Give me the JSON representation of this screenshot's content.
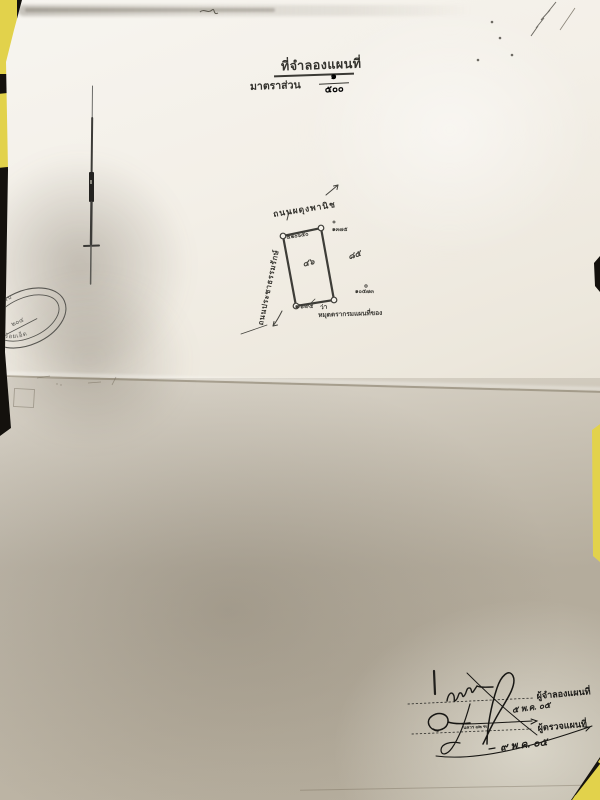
{
  "header": {
    "title": "ที่จำลองแผนที่",
    "scale_label": "มาตราส่วน",
    "scale_numerator": "๑",
    "scale_denominator": "๕๐๐"
  },
  "plot_sketch": {
    "road_top_label": "ถนนผดุงพานิช",
    "road_left_label": "ถนนประชาธรรมรักษ์",
    "corner_labels": {
      "top_left": "๕๒๐๖๕๐",
      "top_right": "๑๓๗๕",
      "bottom_right": "๑๐๕๗๓",
      "bottom_left": "๑/๖/๙๕"
    },
    "inner_mark": "๔๖",
    "side_mark": "๘๕",
    "annotation_prefix": "ว่า",
    "annotation": "หมุดตรากรมแผนที่ของ"
  },
  "stamp": {
    "arc_top": "ทะเบียนรับ",
    "number": "๒๐๔",
    "arc_bottom": "ร้อยเอ็ด"
  },
  "signature_block": {
    "line1_label": "ผู้จำลองแผนที่",
    "line1_date": "๕ พ.ค. ๐๕",
    "line2_label": "ผู้ตรวจแผนที่",
    "line2_date": "๙ พ.ค. ๐๕",
    "line2_note": "นควร ๗๒ ฑ"
  },
  "colors": {
    "paper": "#f3efe7",
    "background": "#14110d",
    "fabric_yellow": "#e2d24b",
    "ink": "#33322d",
    "shadow": "#564b39"
  }
}
